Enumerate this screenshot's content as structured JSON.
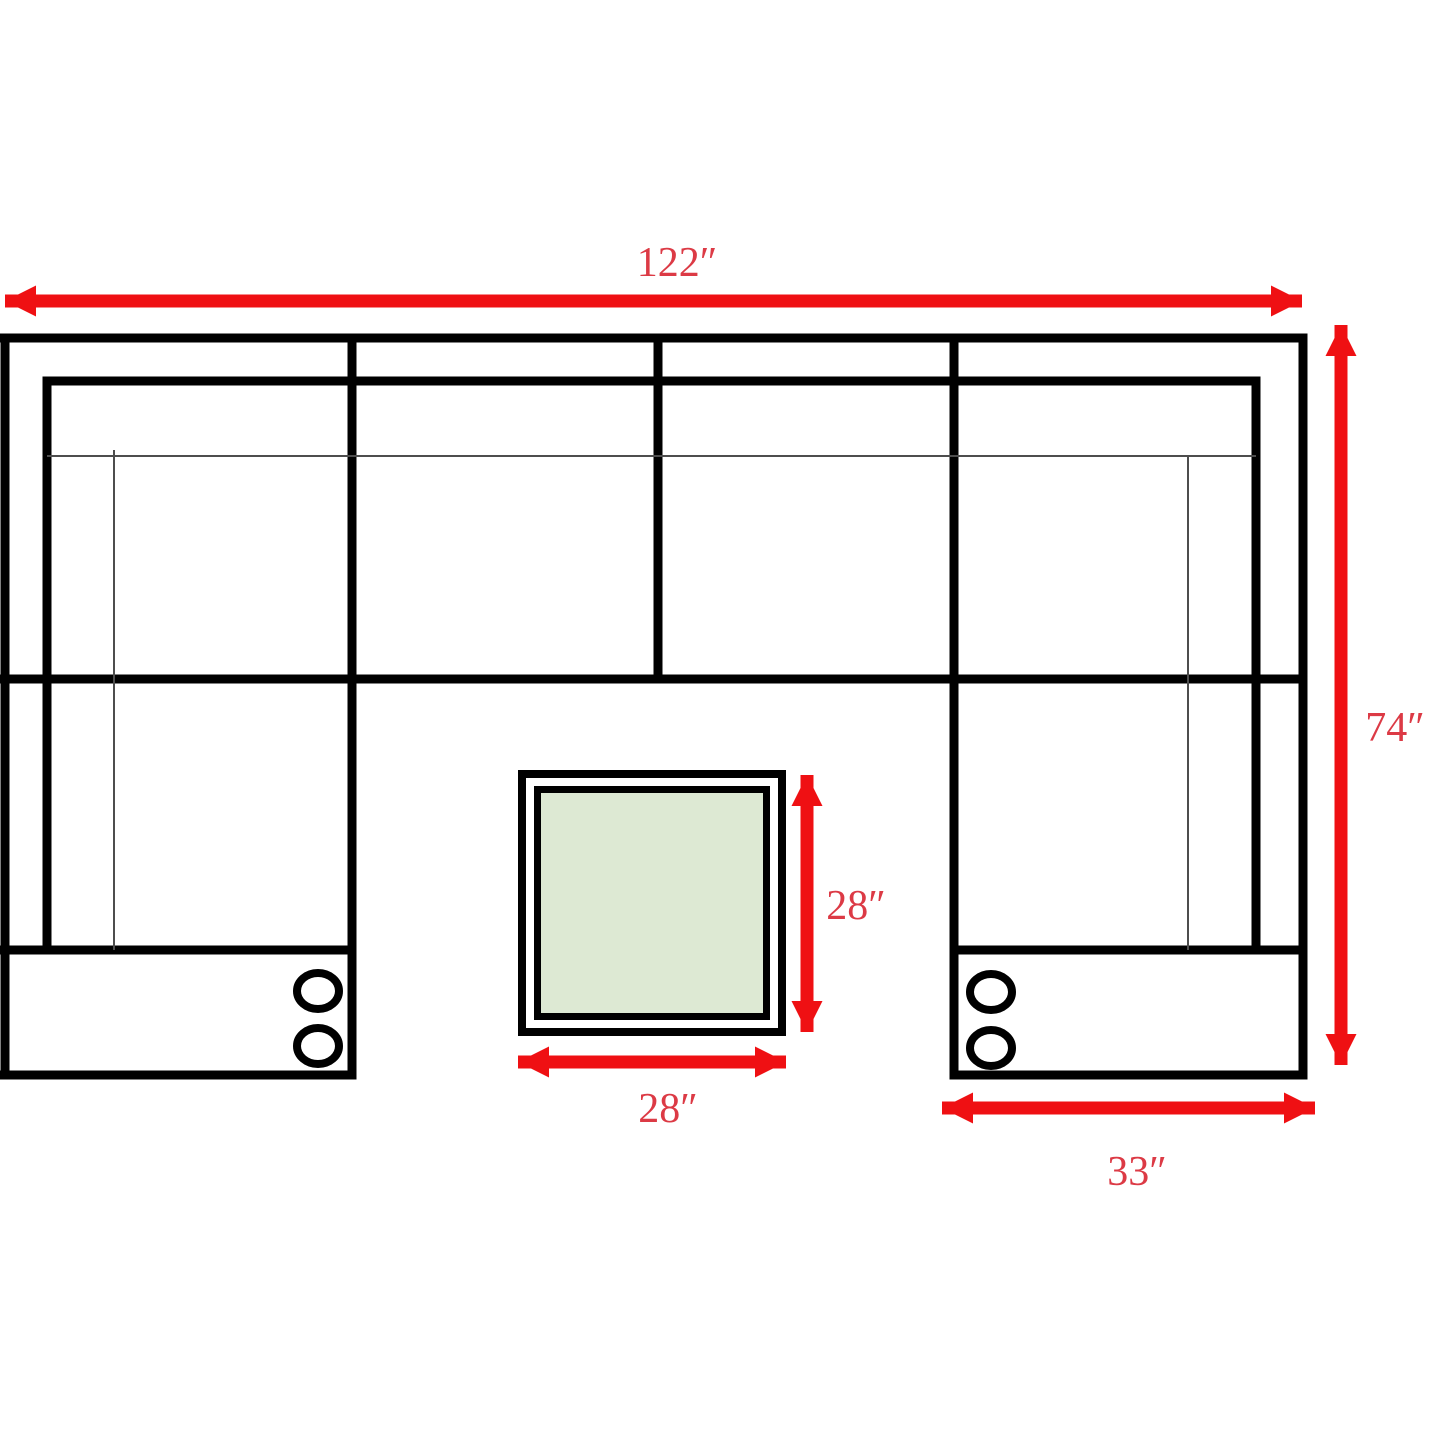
{
  "diagram": {
    "labels": {
      "total_width": "122″",
      "total_depth": "74″",
      "chaise_width": "33″",
      "ottoman_depth": "28″",
      "ottoman_width": "28″"
    },
    "colors": {
      "arrow": "#ef1013",
      "label": "#dc3a45",
      "outline": "#000000",
      "thin_line": "#4d4d4d",
      "table_fill": "#dde9d3",
      "background": "#ffffff"
    }
  }
}
